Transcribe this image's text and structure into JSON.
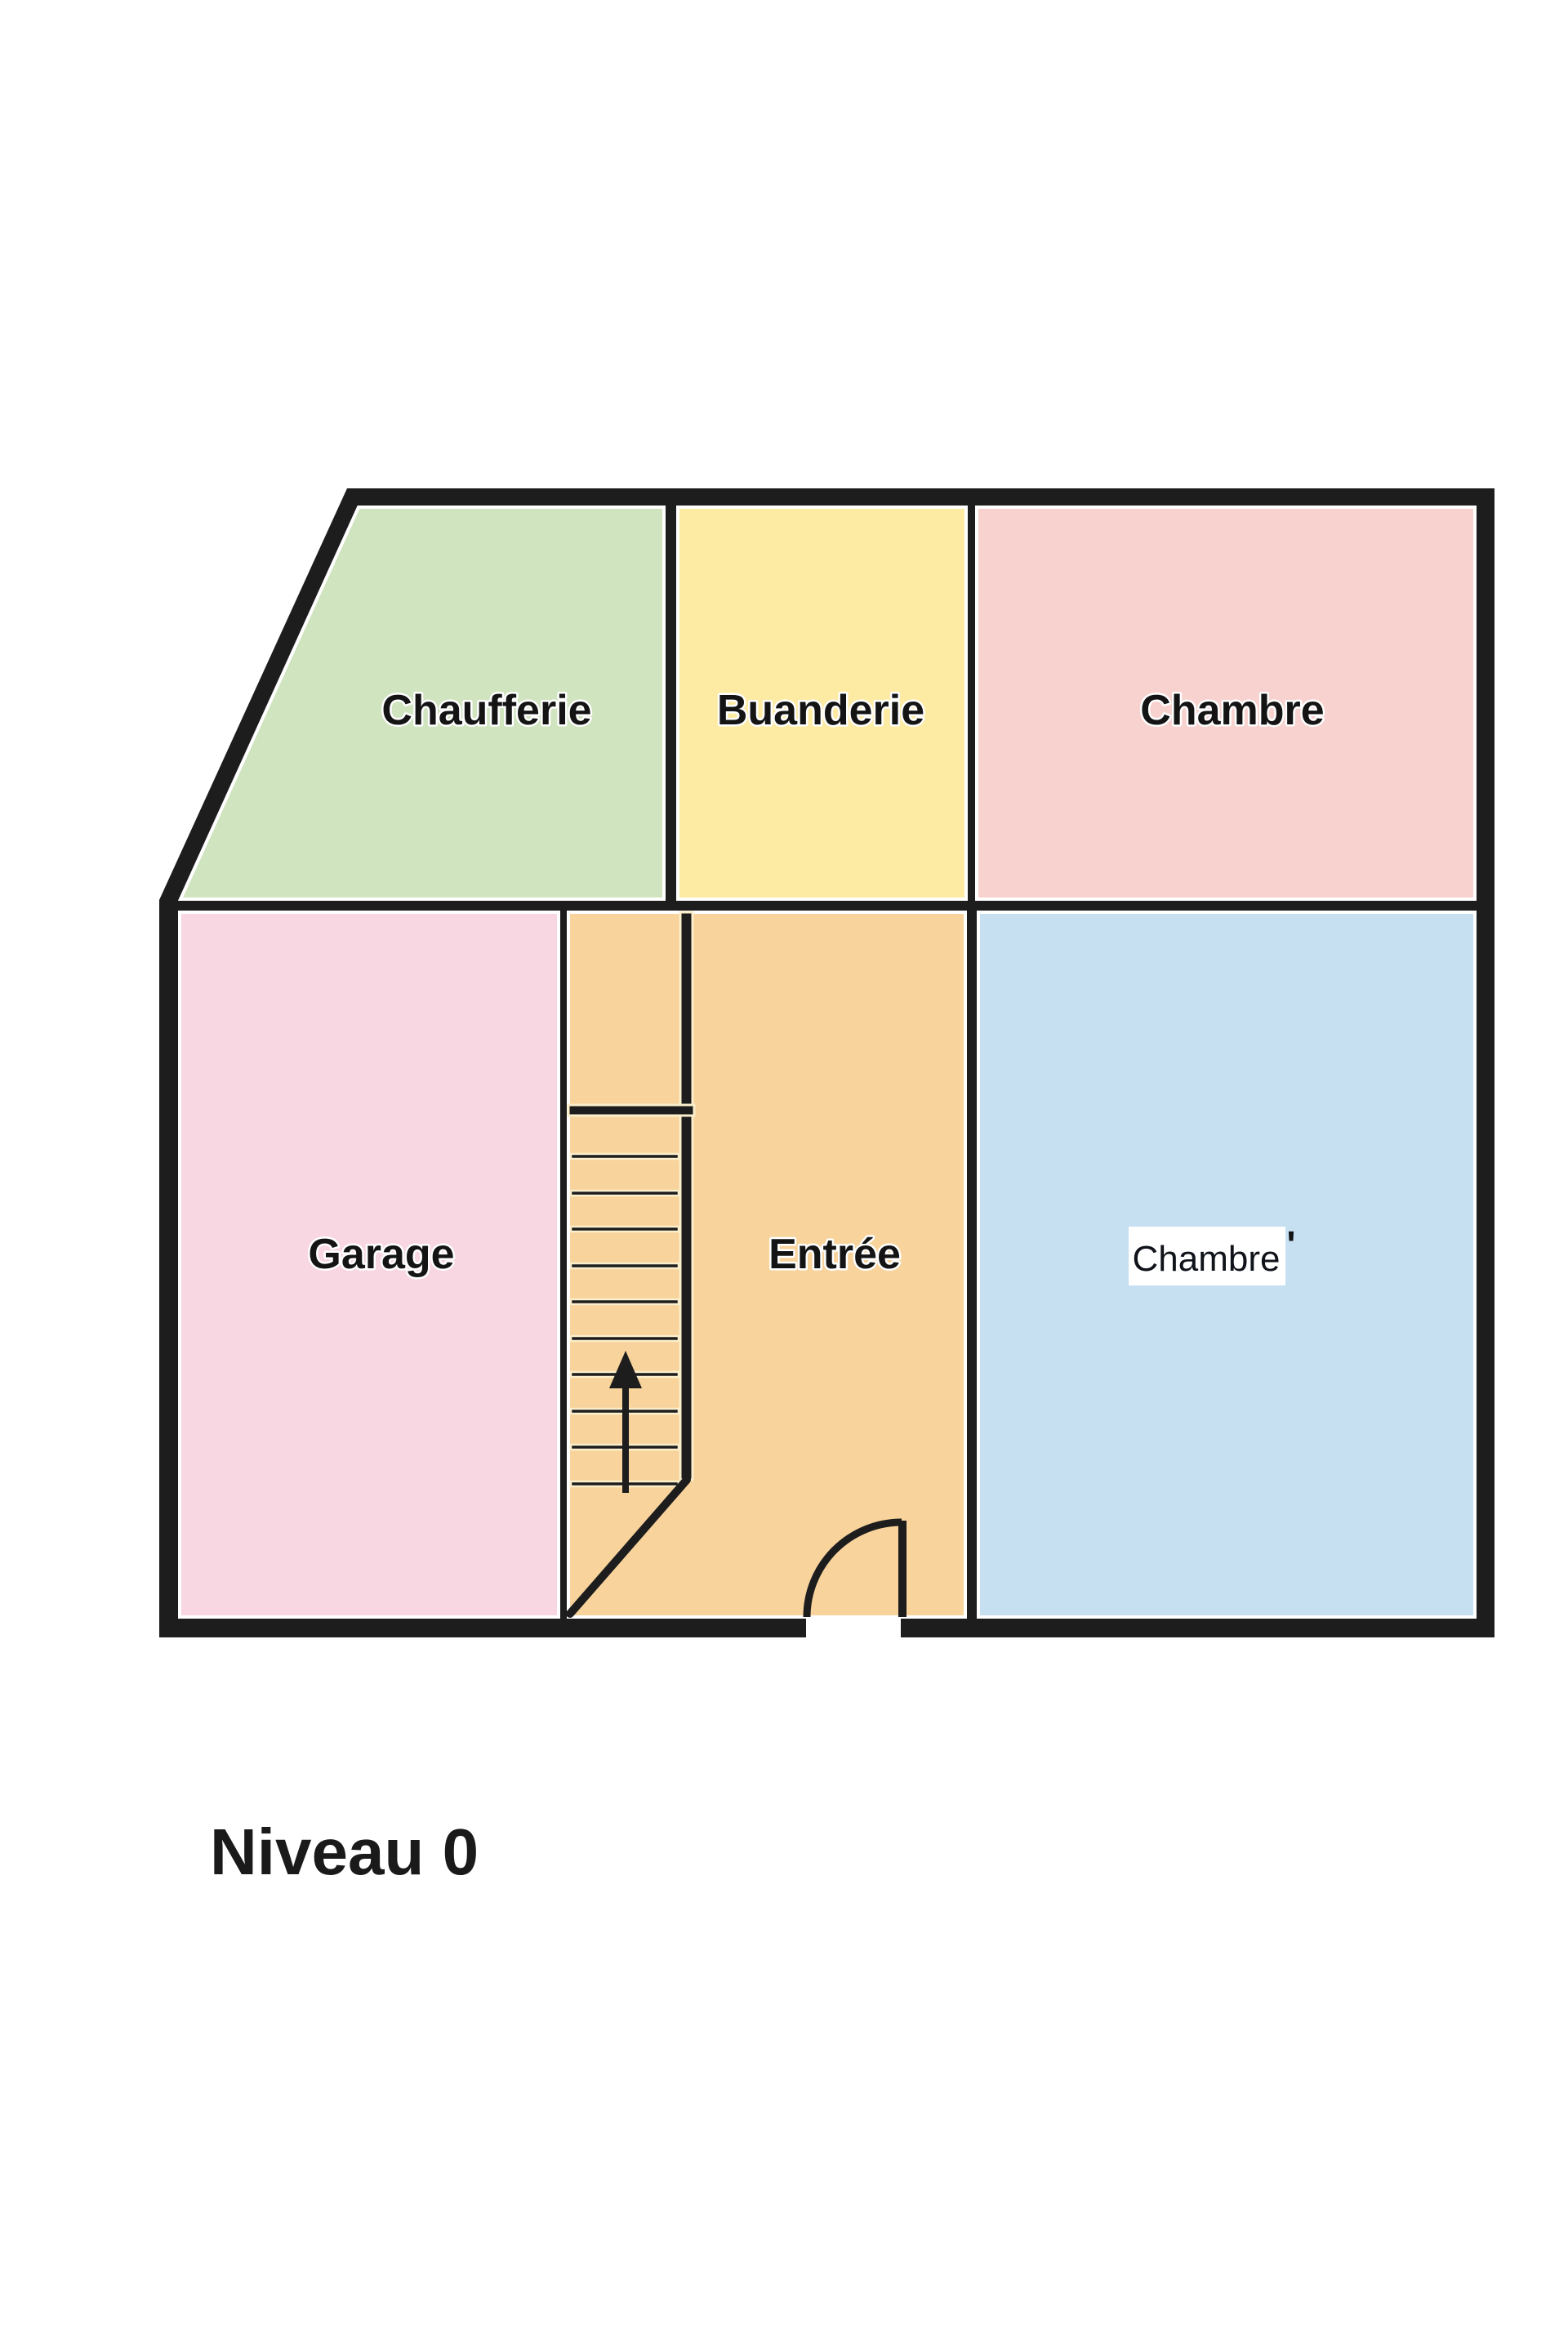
{
  "title": {
    "text": "Niveau 0"
  },
  "palette": {
    "wall": "#1d1d1d",
    "background": "#ffffff",
    "room_outline": "#ffffff",
    "stair_line_halo": "#fbeecb",
    "label_patch": "#ffffff"
  },
  "rooms": [
    {
      "id": "chaufferie",
      "label": "Chaufferie",
      "color": "#d0e4bf"
    },
    {
      "id": "buanderie",
      "label": "Buanderie",
      "color": "#fdeba4"
    },
    {
      "id": "chambre-haut",
      "label": "Chambre",
      "color": "#f8d2ce"
    },
    {
      "id": "garage",
      "label": "Garage",
      "color": "#f8d7e2"
    },
    {
      "id": "entree",
      "label": "Entrée",
      "color": "#f8d39b"
    },
    {
      "id": "chambre-basse",
      "label": "Chambre",
      "color": "#c6e0f2",
      "label_background": "#ffffff",
      "annotation_mark": "'"
    }
  ],
  "stairs": {
    "tread_count": 10,
    "arrow_direction": "up"
  },
  "door": {
    "symbol": "quarter-circle-swing",
    "hinge_side": "right"
  }
}
